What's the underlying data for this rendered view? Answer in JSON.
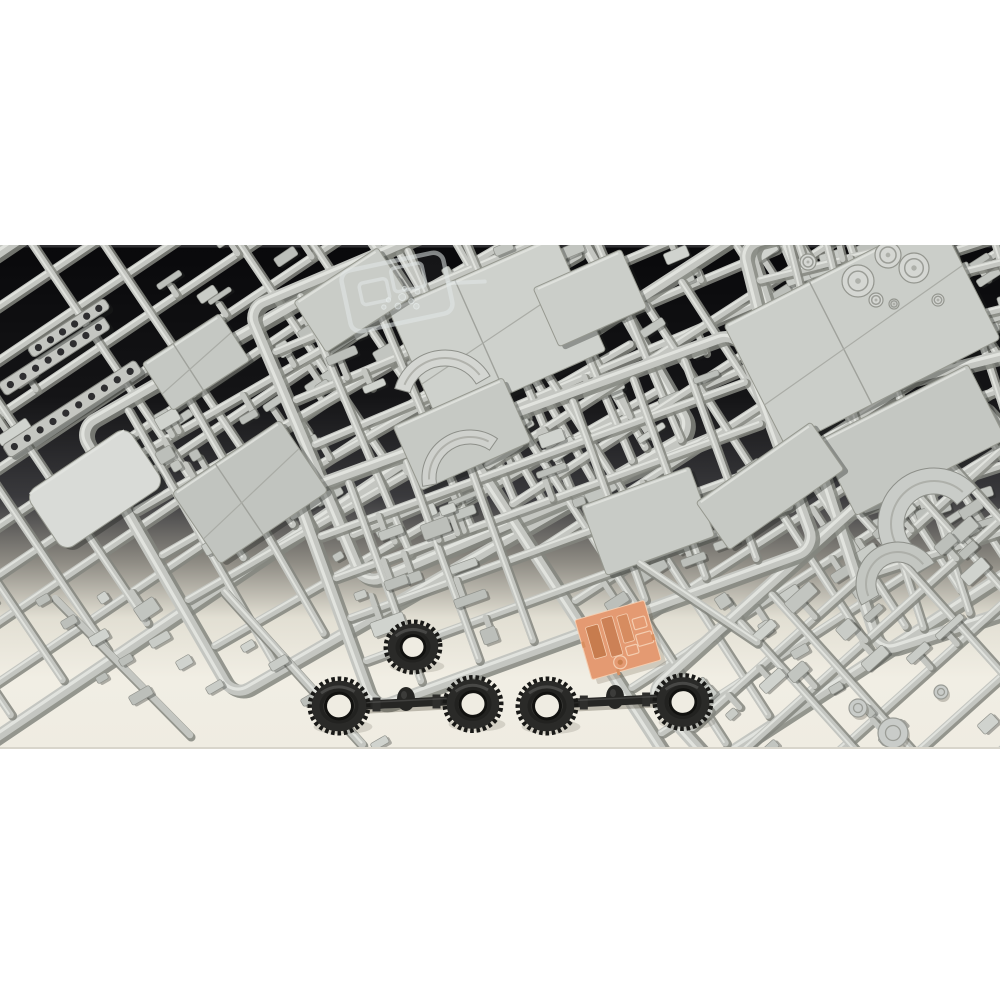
{
  "scene": {
    "subject": "plastic model kit sprues photographed on a dark-to-light studio backdrop with black tires and an orange photo-etch sheet",
    "background": {
      "photo_top": 245,
      "photo_bottom": 749,
      "gradient": [
        [
          0,
          "#09090b"
        ],
        [
          0.3,
          "#141416"
        ],
        [
          0.5,
          "#3a3a3d"
        ],
        [
          0.63,
          "#8f8c84"
        ],
        [
          0.74,
          "#e2dfd3"
        ],
        [
          0.86,
          "#f1eee4"
        ],
        [
          1,
          "#efece2"
        ]
      ],
      "edge_line_color": "#303033",
      "page_color": "#ffffff"
    },
    "colors": {
      "sprue": "#c4c6c1",
      "sprue_shadow": "#84867f",
      "sprue_highlight": "#e4e6e1",
      "part_tones": [
        "#c9ccc7",
        "#c2c5c0",
        "#d0d3ce",
        "#bcbfba"
      ],
      "part_edge": "#8f918b",
      "tire_body": "#2a2a28",
      "tire_teeth": "#191917",
      "tire_dark": "#222220",
      "tire_ring": "#3b3b38",
      "surface_cream": "#efece2",
      "etch_base": "#e49a72",
      "etch_dark1": "#c77c4e",
      "etch_dark2": "#cc8156",
      "etch_dark3": "#d68c60",
      "etch_line": "#f4cdb0",
      "clear_plastic": "rgba(226,231,231,0.55)"
    },
    "sprues": [
      {
        "cx": 115,
        "cy": 415,
        "w": 620,
        "h": 400,
        "angle": -34,
        "longBars": 8,
        "crossBars": 10,
        "seed": 11,
        "parts": 26
      },
      {
        "cx": 385,
        "cy": 430,
        "w": 530,
        "h": 310,
        "angle": -30,
        "longBars": 5,
        "crossBars": 9,
        "seed": 22,
        "parts": 22
      },
      {
        "cx": 545,
        "cy": 345,
        "w": 520,
        "h": 300,
        "angle": -23,
        "longBars": 5,
        "crossBars": 8,
        "seed": 33,
        "parts": 20
      },
      {
        "cx": 800,
        "cy": 450,
        "w": 560,
        "h": 430,
        "angle": -33,
        "longBars": 7,
        "crossBars": 9,
        "seed": 44,
        "parts": 26
      },
      {
        "cx": 975,
        "cy": 395,
        "w": 340,
        "h": 430,
        "angle": -18,
        "longBars": 5,
        "crossBars": 6,
        "seed": 55,
        "parts": 16
      },
      {
        "cx": 893,
        "cy": 295,
        "w": 270,
        "h": 170,
        "angle": -14,
        "longBars": 3,
        "crossBars": 5,
        "seed": 66,
        "parts": 10
      },
      {
        "cx": 905,
        "cy": 650,
        "w": 440,
        "h": 280,
        "angle": -42,
        "longBars": 4,
        "crossBars": 7,
        "seed": 77,
        "parts": 18
      },
      {
        "cx": 555,
        "cy": 520,
        "w": 470,
        "h": 230,
        "angle": -20,
        "longBars": 4,
        "crossBars": 7,
        "seed": 88,
        "parts": 16
      }
    ],
    "panels": [
      {
        "cx": 95,
        "cy": 489,
        "w": 122,
        "h": 70,
        "rot": -34,
        "fill": "#d9dbd7",
        "rx": 12,
        "fold": false
      },
      {
        "cx": 250,
        "cy": 492,
        "w": 130,
        "h": 86,
        "rot": -34,
        "fill": "#c1c4bf",
        "rx": 4,
        "fold": true
      },
      {
        "cx": 497,
        "cy": 330,
        "w": 182,
        "h": 126,
        "rot": -24,
        "fill": "#ced1cc",
        "rx": 3,
        "fold": true
      },
      {
        "cx": 462,
        "cy": 434,
        "w": 120,
        "h": 70,
        "rot": -24,
        "fill": "#c6c9c4",
        "rx": 3,
        "fold": false
      },
      {
        "cx": 590,
        "cy": 298,
        "w": 96,
        "h": 64,
        "rot": -24,
        "fill": "#cbcec9",
        "rx": 3,
        "fold": false
      },
      {
        "cx": 862,
        "cy": 332,
        "w": 240,
        "h": 138,
        "rot": -27,
        "fill": "#cbcec9",
        "rx": 4,
        "fold": true
      },
      {
        "cx": 912,
        "cy": 440,
        "w": 168,
        "h": 84,
        "rot": -27,
        "fill": "#c4c7c2",
        "rx": 3,
        "fold": false
      },
      {
        "cx": 648,
        "cy": 521,
        "w": 115,
        "h": 74,
        "rot": -20,
        "fill": "#c8cbc6",
        "rx": 3,
        "fold": false
      },
      {
        "cx": 770,
        "cy": 486,
        "w": 140,
        "h": 58,
        "rot": -35,
        "fill": "#c6c9c4",
        "rx": 3,
        "fold": false
      },
      {
        "cx": 352,
        "cy": 300,
        "w": 100,
        "h": 60,
        "rot": -33,
        "fill": "#c9ccc7",
        "rx": 3,
        "fold": false
      },
      {
        "cx": 196,
        "cy": 362,
        "w": 92,
        "h": 56,
        "rot": -33,
        "fill": "#c5c8c3",
        "rx": 3,
        "fold": true
      }
    ],
    "strips": [
      {
        "x": 2,
        "y": 390,
        "len": 125,
        "w": 15,
        "rot": -33,
        "holes": 8
      },
      {
        "x": 6,
        "y": 452,
        "len": 158,
        "w": 15,
        "rot": -33,
        "holes": 10
      },
      {
        "x": 30,
        "y": 353,
        "len": 92,
        "w": 12,
        "rot": -33,
        "holes": 6
      }
    ],
    "dials": [
      {
        "cx": 858,
        "cy": 281,
        "r": 16
      },
      {
        "cx": 888,
        "cy": 255,
        "r": 13
      },
      {
        "cx": 914,
        "cy": 268,
        "r": 15
      },
      {
        "cx": 876,
        "cy": 300,
        "r": 7
      },
      {
        "cx": 894,
        "cy": 304,
        "r": 5
      },
      {
        "cx": 938,
        "cy": 300,
        "r": 6
      },
      {
        "cx": 808,
        "cy": 262,
        "r": 8
      }
    ],
    "arcs": [
      {
        "cx": 445,
        "cy": 402,
        "rOut": 52,
        "rIn": 36,
        "a0": 195,
        "a1": 330,
        "fill": "#d4d6d2"
      },
      {
        "cx": 470,
        "cy": 478,
        "rOut": 48,
        "rIn": 34,
        "a0": 170,
        "a1": 305,
        "fill": "#cfd1cd"
      },
      {
        "cx": 934,
        "cy": 524,
        "rOut": 56,
        "rIn": 30,
        "a0": 140,
        "a1": 320,
        "fill": "#c9ccc8"
      },
      {
        "cx": 898,
        "cy": 584,
        "rOut": 42,
        "rIn": 22,
        "a0": 150,
        "a1": 330,
        "fill": "#c3c6c1"
      }
    ],
    "clear_sprue": {
      "cx": 397,
      "cy": 292,
      "rot": -12,
      "w": 104,
      "h": 62
    },
    "extra_runners": [
      [
        225,
        592,
        362,
        744,
        8
      ],
      [
        55,
        598,
        190,
        735,
        6.5
      ],
      [
        640,
        563,
        757,
        642,
        7
      ]
    ],
    "scatter_parts": [
      [
        60,
        622,
        16,
        9
      ],
      [
        88,
        638,
        20,
        10
      ],
      [
        118,
        660,
        14,
        8
      ],
      [
        148,
        641,
        22,
        9
      ],
      [
        175,
        662,
        16,
        10
      ],
      [
        205,
        688,
        18,
        8
      ],
      [
        240,
        646,
        14,
        8
      ],
      [
        268,
        664,
        20,
        9
      ],
      [
        300,
        700,
        16,
        8
      ],
      [
        330,
        716,
        14,
        7
      ],
      [
        128,
        697,
        24,
        10
      ],
      [
        95,
        678,
        12,
        7
      ],
      [
        370,
        744,
        18,
        8
      ],
      [
        35,
        600,
        14,
        8
      ],
      [
        790,
        652,
        18,
        9
      ],
      [
        828,
        688,
        14,
        8
      ]
    ],
    "discs": [
      [
        893,
        733,
        15
      ],
      [
        858,
        708,
        9
      ],
      [
        941,
        692,
        7
      ]
    ],
    "tires": [
      {
        "cx": 413,
        "cy": 647,
        "rx": 26,
        "ry": 24,
        "holeR": 12,
        "rot": -8,
        "single": true
      },
      {
        "cx": 339,
        "cy": 706,
        "rx": 28,
        "ry": 26,
        "holeR": 13.5,
        "rot": -5
      },
      {
        "cx": 473,
        "cy": 704,
        "rx": 27,
        "ry": 25.5,
        "holeR": 13,
        "rot": -5
      },
      {
        "cx": 547,
        "cy": 706,
        "rx": 28,
        "ry": 26,
        "holeR": 13.5,
        "rot": -5
      },
      {
        "cx": 683,
        "cy": 702,
        "rx": 27,
        "ry": 25.5,
        "holeR": 13,
        "rot": -5
      }
    ],
    "axles": [
      {
        "x1": 367,
        "y1": 705,
        "x2": 446,
        "y2": 701,
        "w": 9,
        "bulge": {
          "cx": 406,
          "cy": 699,
          "rx": 9,
          "ry": 12
        }
      },
      {
        "x1": 574,
        "y1": 703,
        "x2": 656,
        "y2": 699,
        "w": 9,
        "bulge": {
          "cx": 615,
          "cy": 697,
          "rx": 9,
          "ry": 12
        }
      }
    ],
    "etch_sheet": {
      "cx": 618,
      "cy": 640,
      "w": 72,
      "h": 62,
      "rot": -16,
      "fill_rects": [
        {
          "x": -28,
          "y": -21,
          "w": 13,
          "h": 33,
          "tone": "etch_dark1"
        },
        {
          "x": -11,
          "y": -25,
          "w": 12,
          "h": 40,
          "tone": "etch_dark2"
        },
        {
          "x": 5,
          "y": -23,
          "w": 11,
          "h": 28,
          "tone": "etch_dark3"
        }
      ],
      "outline_rects": [
        {
          "x": 19,
          "y": -16,
          "w": 13,
          "h": 11
        },
        {
          "x": 18,
          "y": 0,
          "w": 16,
          "h": 12
        },
        {
          "x": 5,
          "y": 9,
          "w": 12,
          "h": 9
        }
      ],
      "circle": {
        "x": -4,
        "y": 22,
        "r": 6.5
      }
    }
  }
}
